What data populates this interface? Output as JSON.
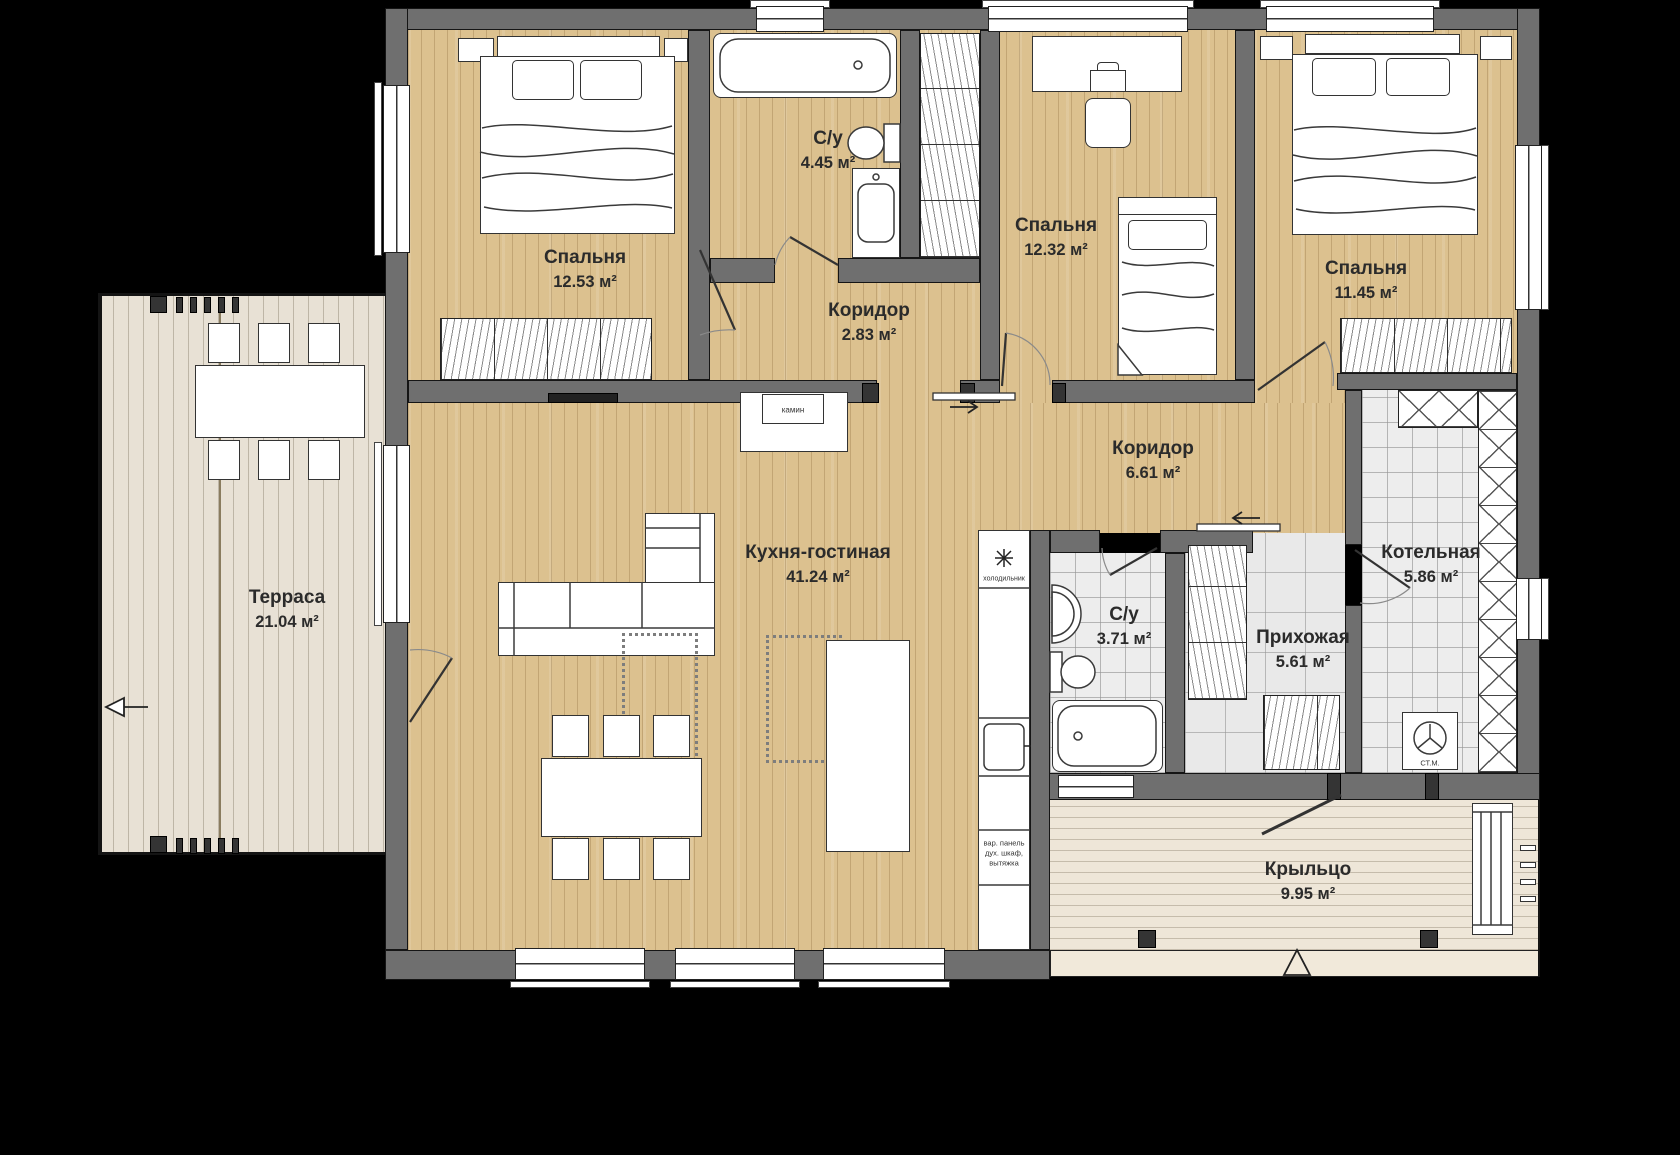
{
  "plan": {
    "type": "floor-plan",
    "units": "м²",
    "colors": {
      "background": "#000000",
      "wall": "#6f6f6f",
      "wood_floor": "#dcc18f",
      "terrace_deck": "#e8e1d5",
      "porch_deck": "#eee6d8",
      "tile_floor": "#ededed",
      "furniture": "#ffffff",
      "label_text": "#2b2b2b"
    }
  },
  "rooms": [
    {
      "id": "bedroom-1",
      "name": "Спальня",
      "area": "12.53 м²"
    },
    {
      "id": "bathroom-top",
      "name": "С/у",
      "area": "4.45 м²"
    },
    {
      "id": "bedroom-2",
      "name": "Спальня",
      "area": "12.32 м²"
    },
    {
      "id": "bedroom-3",
      "name": "Спальня",
      "area": "11.45 м²"
    },
    {
      "id": "corridor-small",
      "name": "Коридор",
      "area": "2.83 м²"
    },
    {
      "id": "corridor-main",
      "name": "Коридор",
      "area": "6.61 м²"
    },
    {
      "id": "kitchen-living",
      "name": "Кухня-гостиная",
      "area": "41.24 м²"
    },
    {
      "id": "bathroom-bottom",
      "name": "С/у",
      "area": "3.71 м²"
    },
    {
      "id": "hallway",
      "name": "Прихожая",
      "area": "5.61 м²"
    },
    {
      "id": "boiler-room",
      "name": "Котельная",
      "area": "5.86 м²"
    },
    {
      "id": "terrace",
      "name": "Терраса",
      "area": "21.04 м²"
    },
    {
      "id": "porch",
      "name": "Крыльцо",
      "area": "9.95 м²"
    }
  ],
  "annotations": {
    "fireplace": "камин",
    "fridge": "холодильник",
    "appliances": "вар. панель\nдух. шкаф,\nвытяжка",
    "washer": "СТ.М."
  },
  "icons": {
    "fridge": "snowflake-icon",
    "corridor_small_door": "arrow-right-icon",
    "corridor_main_door": "arrow-left-icon",
    "porch_entry": "entrance-arrow-up-icon",
    "terrace_exit": "exit-arrow-left-icon"
  }
}
